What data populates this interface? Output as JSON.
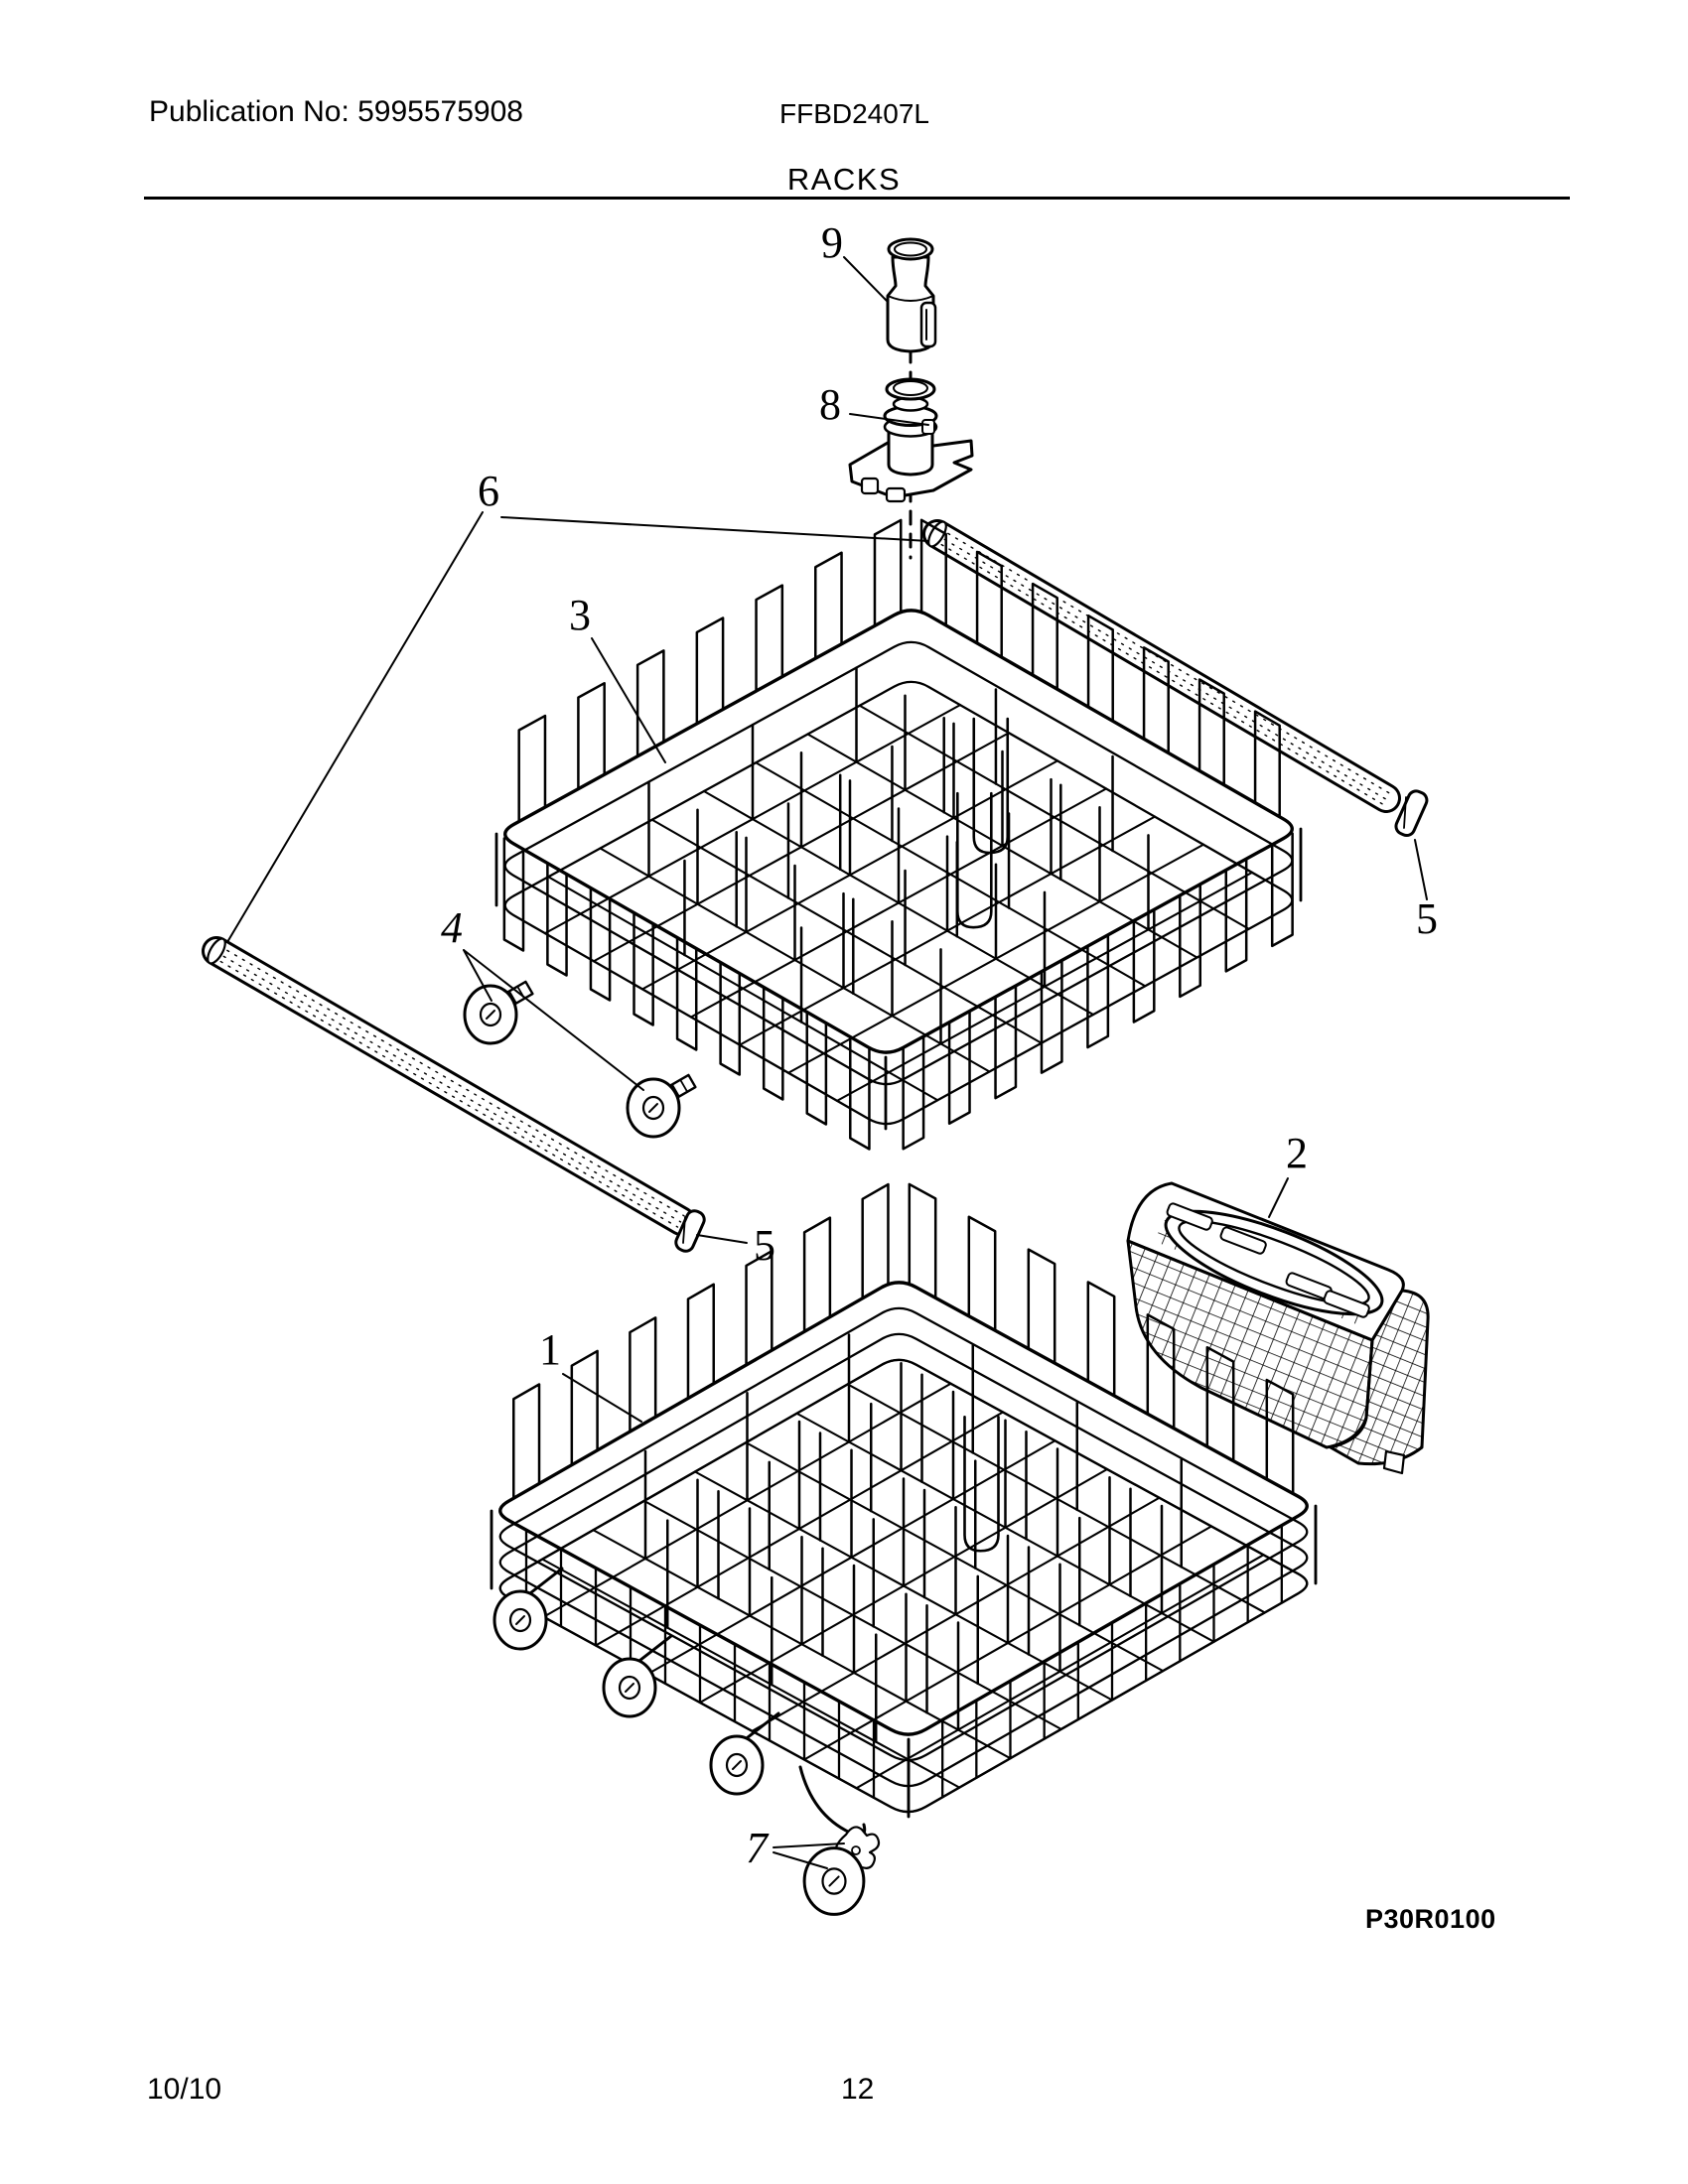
{
  "header": {
    "publication": "Publication No: 5995575908",
    "model": "FFBD2407L"
  },
  "title": "RACKS",
  "callouts": {
    "p1": "1",
    "p2": "2",
    "p3": "3",
    "p4": "4",
    "p5": "5",
    "p6": "6",
    "p7": "7",
    "p8": "8",
    "p9": "9"
  },
  "diagram": {
    "code": "P30R0100"
  },
  "footer": {
    "issue": "10/10",
    "page": "12"
  }
}
